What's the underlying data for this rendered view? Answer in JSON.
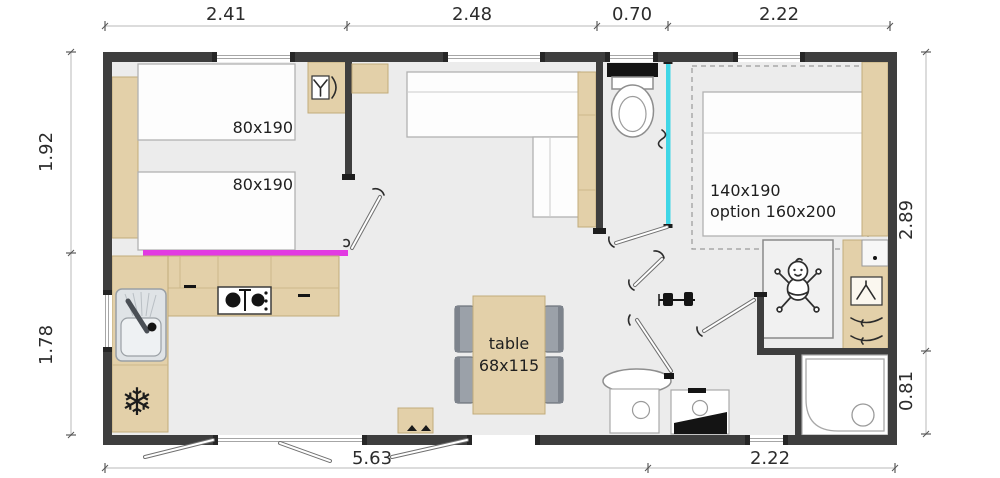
{
  "plan": {
    "title": "mobile-home floor plan",
    "dims": {
      "top": [
        "2.41",
        "2.48",
        "0.70",
        "2.22"
      ],
      "left": [
        "1.92",
        "1.78"
      ],
      "right": [
        "2.89",
        "0.81"
      ],
      "bottom": [
        "5.63",
        "2.22"
      ]
    },
    "labels": {
      "single_bed_1": "80x190",
      "single_bed_2": "80x190",
      "double_bed": "140x190",
      "double_bed_option": "option 160x200",
      "table_line1": "table",
      "table_line2": "68x115"
    },
    "icons": {
      "fridge_glyph": "❄",
      "fridge": "snowflake-icon",
      "wardrobe": "hanging-clothes-icon",
      "baby": "baby-cot-icon"
    },
    "colors": {
      "wall": "#3e3e3e",
      "wood": "#e3d0a9",
      "floor": "#ececec",
      "counter_highlight": "#e23ae2",
      "sliding_door": "#3fd6e6",
      "chair": "#9ba1a9"
    }
  }
}
